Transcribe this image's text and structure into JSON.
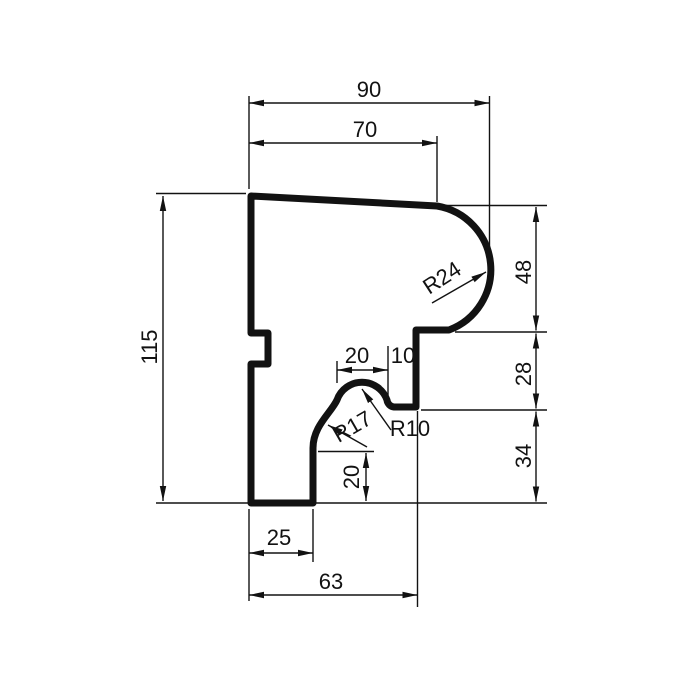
{
  "drawing": {
    "type": "technical-profile-cross-section",
    "colors": {
      "line": "#121212",
      "background": "#ffffff"
    },
    "labels": {
      "overall_width": "90",
      "top_width": "70",
      "overall_height": "115",
      "right_upper_height": "48",
      "right_middle_height": "28",
      "right_lower_height": "34",
      "bead_width": "20",
      "bead_to_edge": "10",
      "inner_step_height": "20",
      "foot_width": "25",
      "base_width": "63",
      "radius_nose": "R24",
      "radius_cove": "R17",
      "radius_bead": "R10"
    }
  }
}
